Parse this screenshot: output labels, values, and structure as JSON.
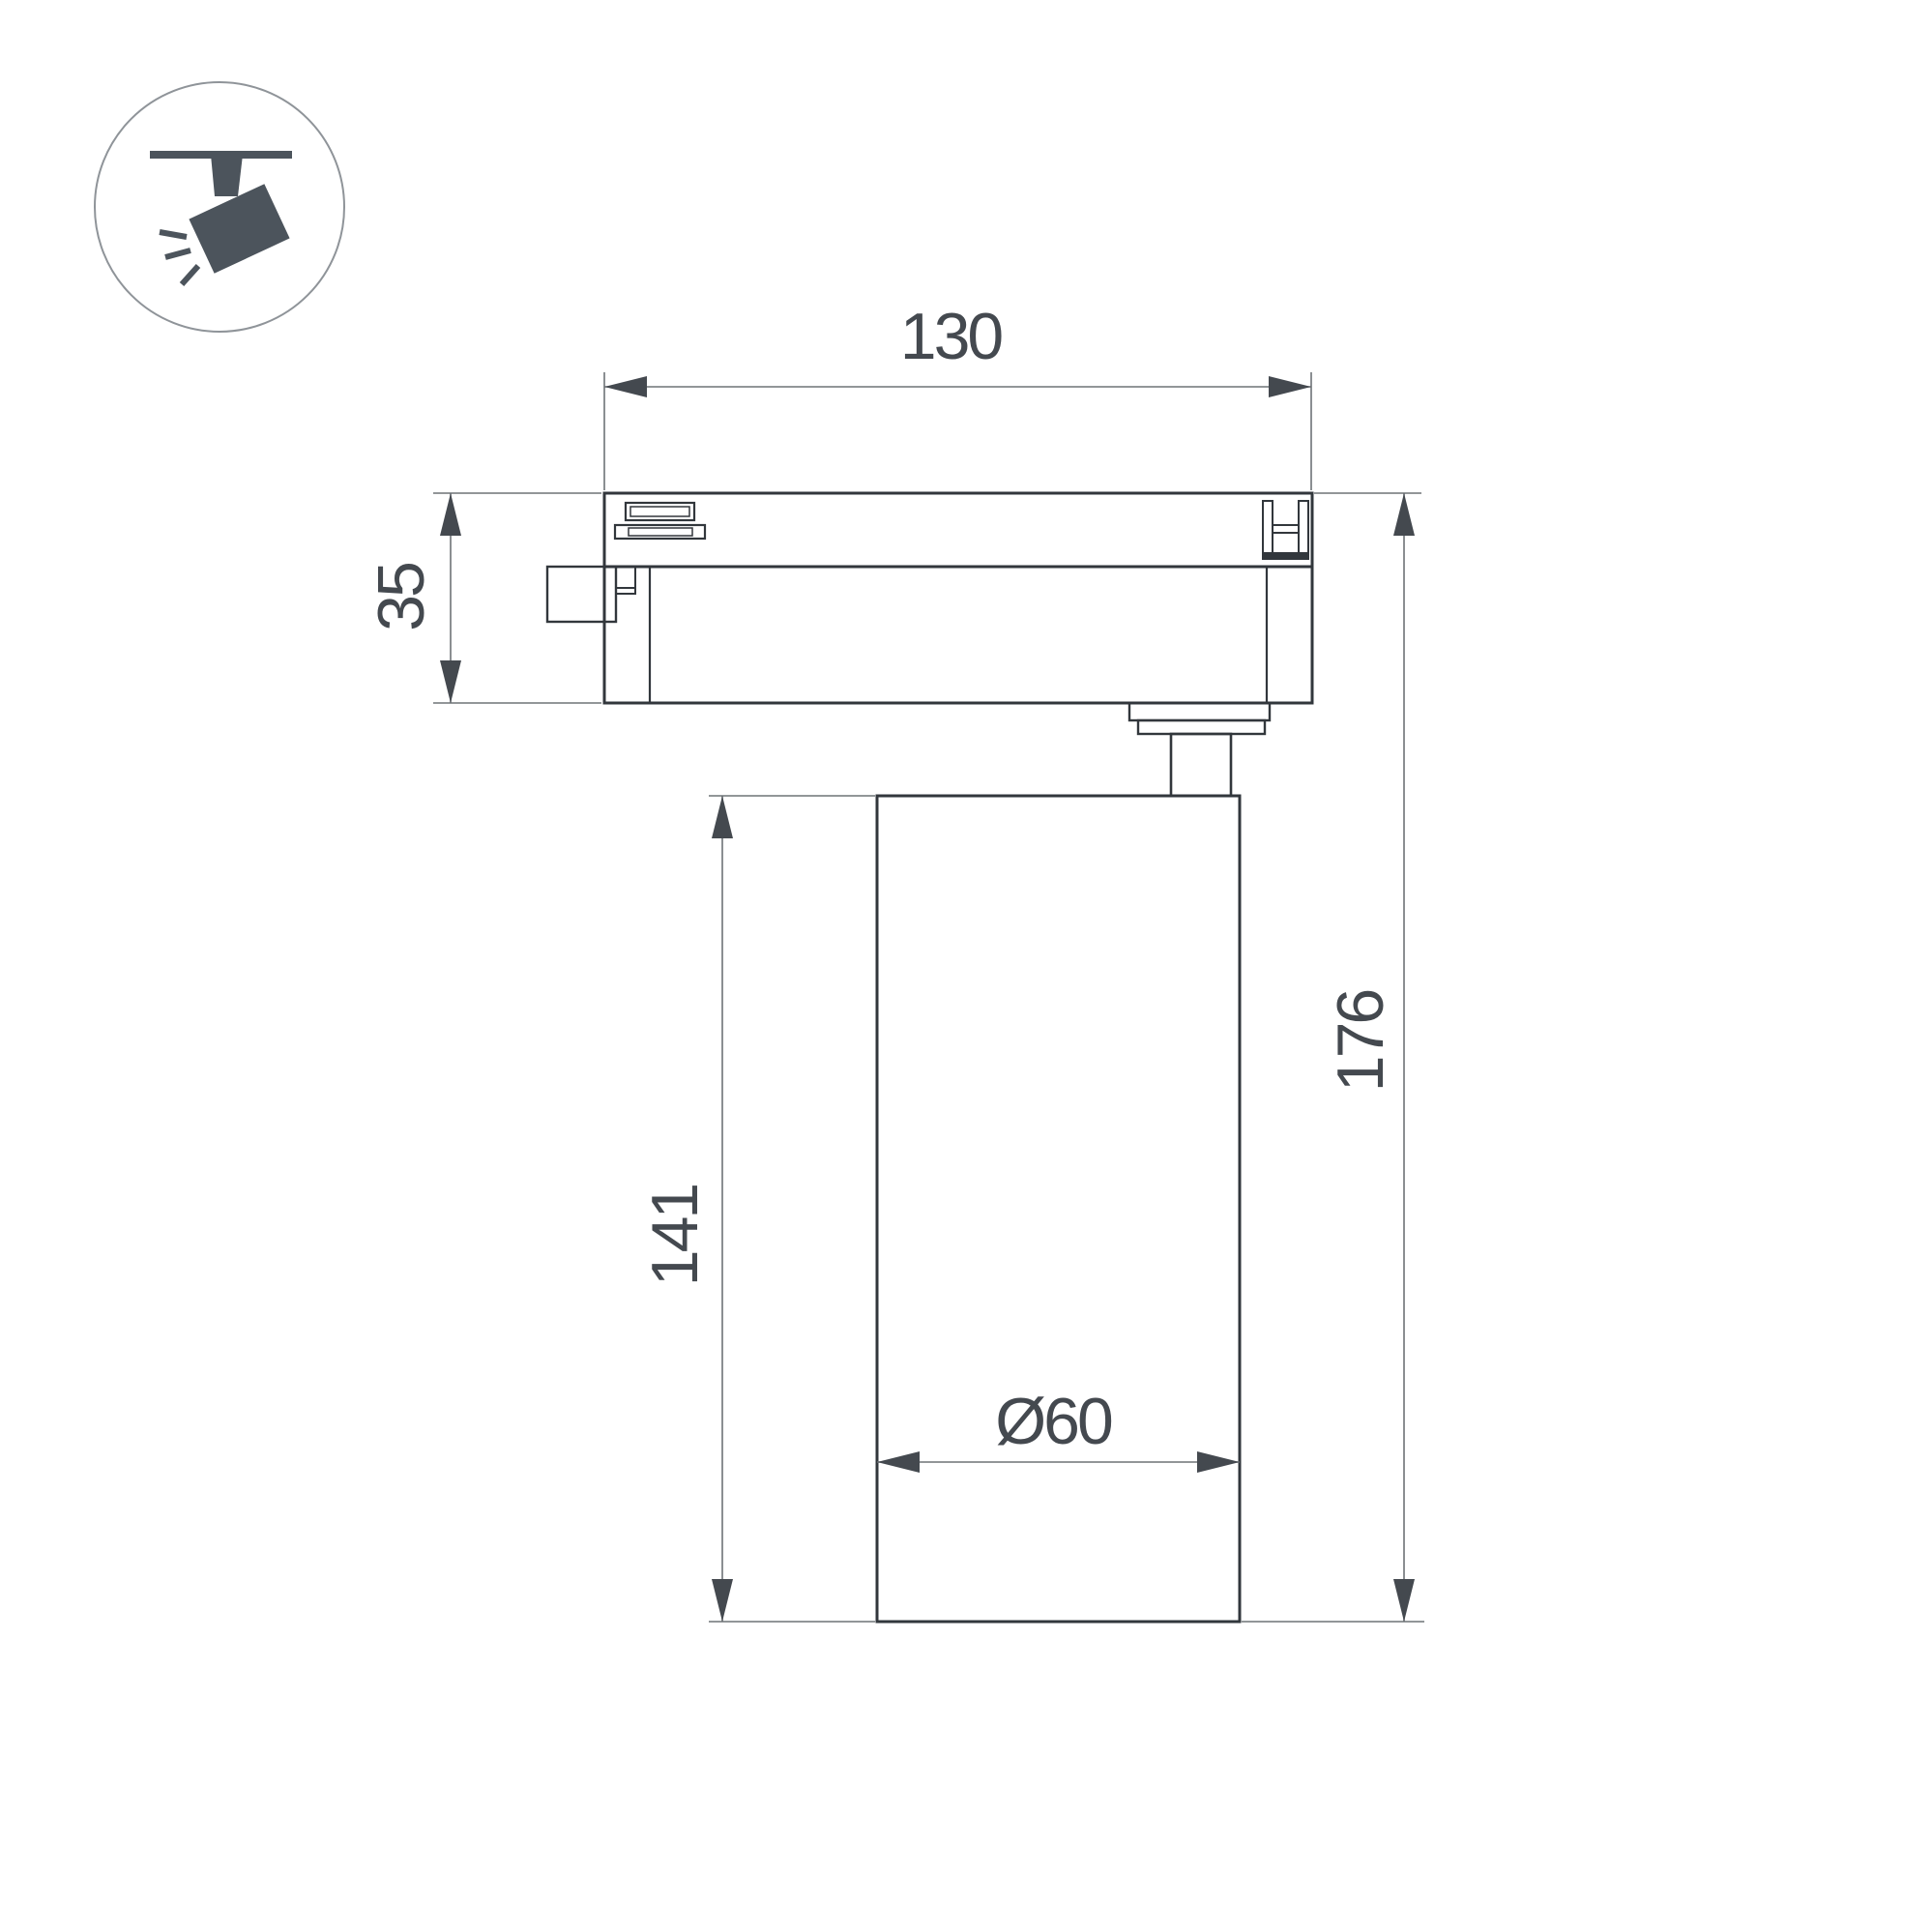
{
  "page": {
    "background": "#ffffff",
    "type_note": "technical dimension drawing of track-mounted spotlight"
  },
  "icon": {
    "name": "track-spotlight",
    "circle_stroke": "#8f9499",
    "glyph_fill": "#4c545c"
  },
  "drawing": {
    "outline_color": "#32373c",
    "dimension_line_color": "#6e7377",
    "arrow_color": "#44494f",
    "label_color": "#44494f",
    "labels": {
      "track_width": "130",
      "track_height": "35",
      "body_height": "141",
      "total_height": "176",
      "body_diameter": "Ø60"
    }
  }
}
